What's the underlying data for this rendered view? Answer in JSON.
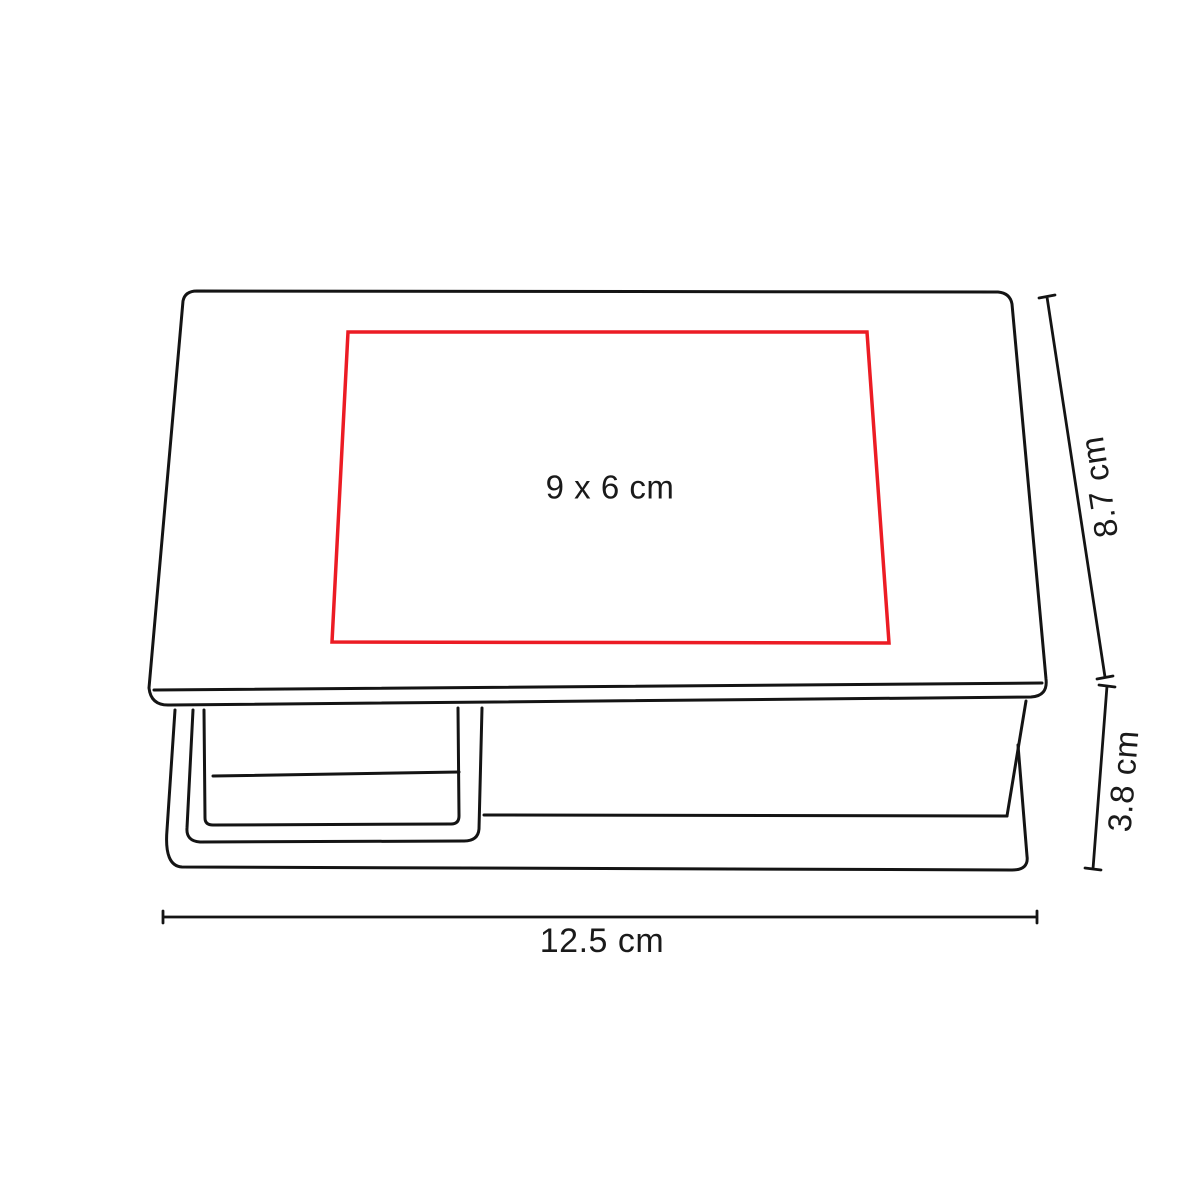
{
  "colors": {
    "line": "#141414",
    "print_area": "#ec1c24",
    "text": "#1a1a1a"
  },
  "diagram": {
    "print_area_label": "9 x 6 cm",
    "depth_label": "8.7 cm",
    "height_label": "3.8 cm",
    "width_label": "12.5 cm"
  }
}
